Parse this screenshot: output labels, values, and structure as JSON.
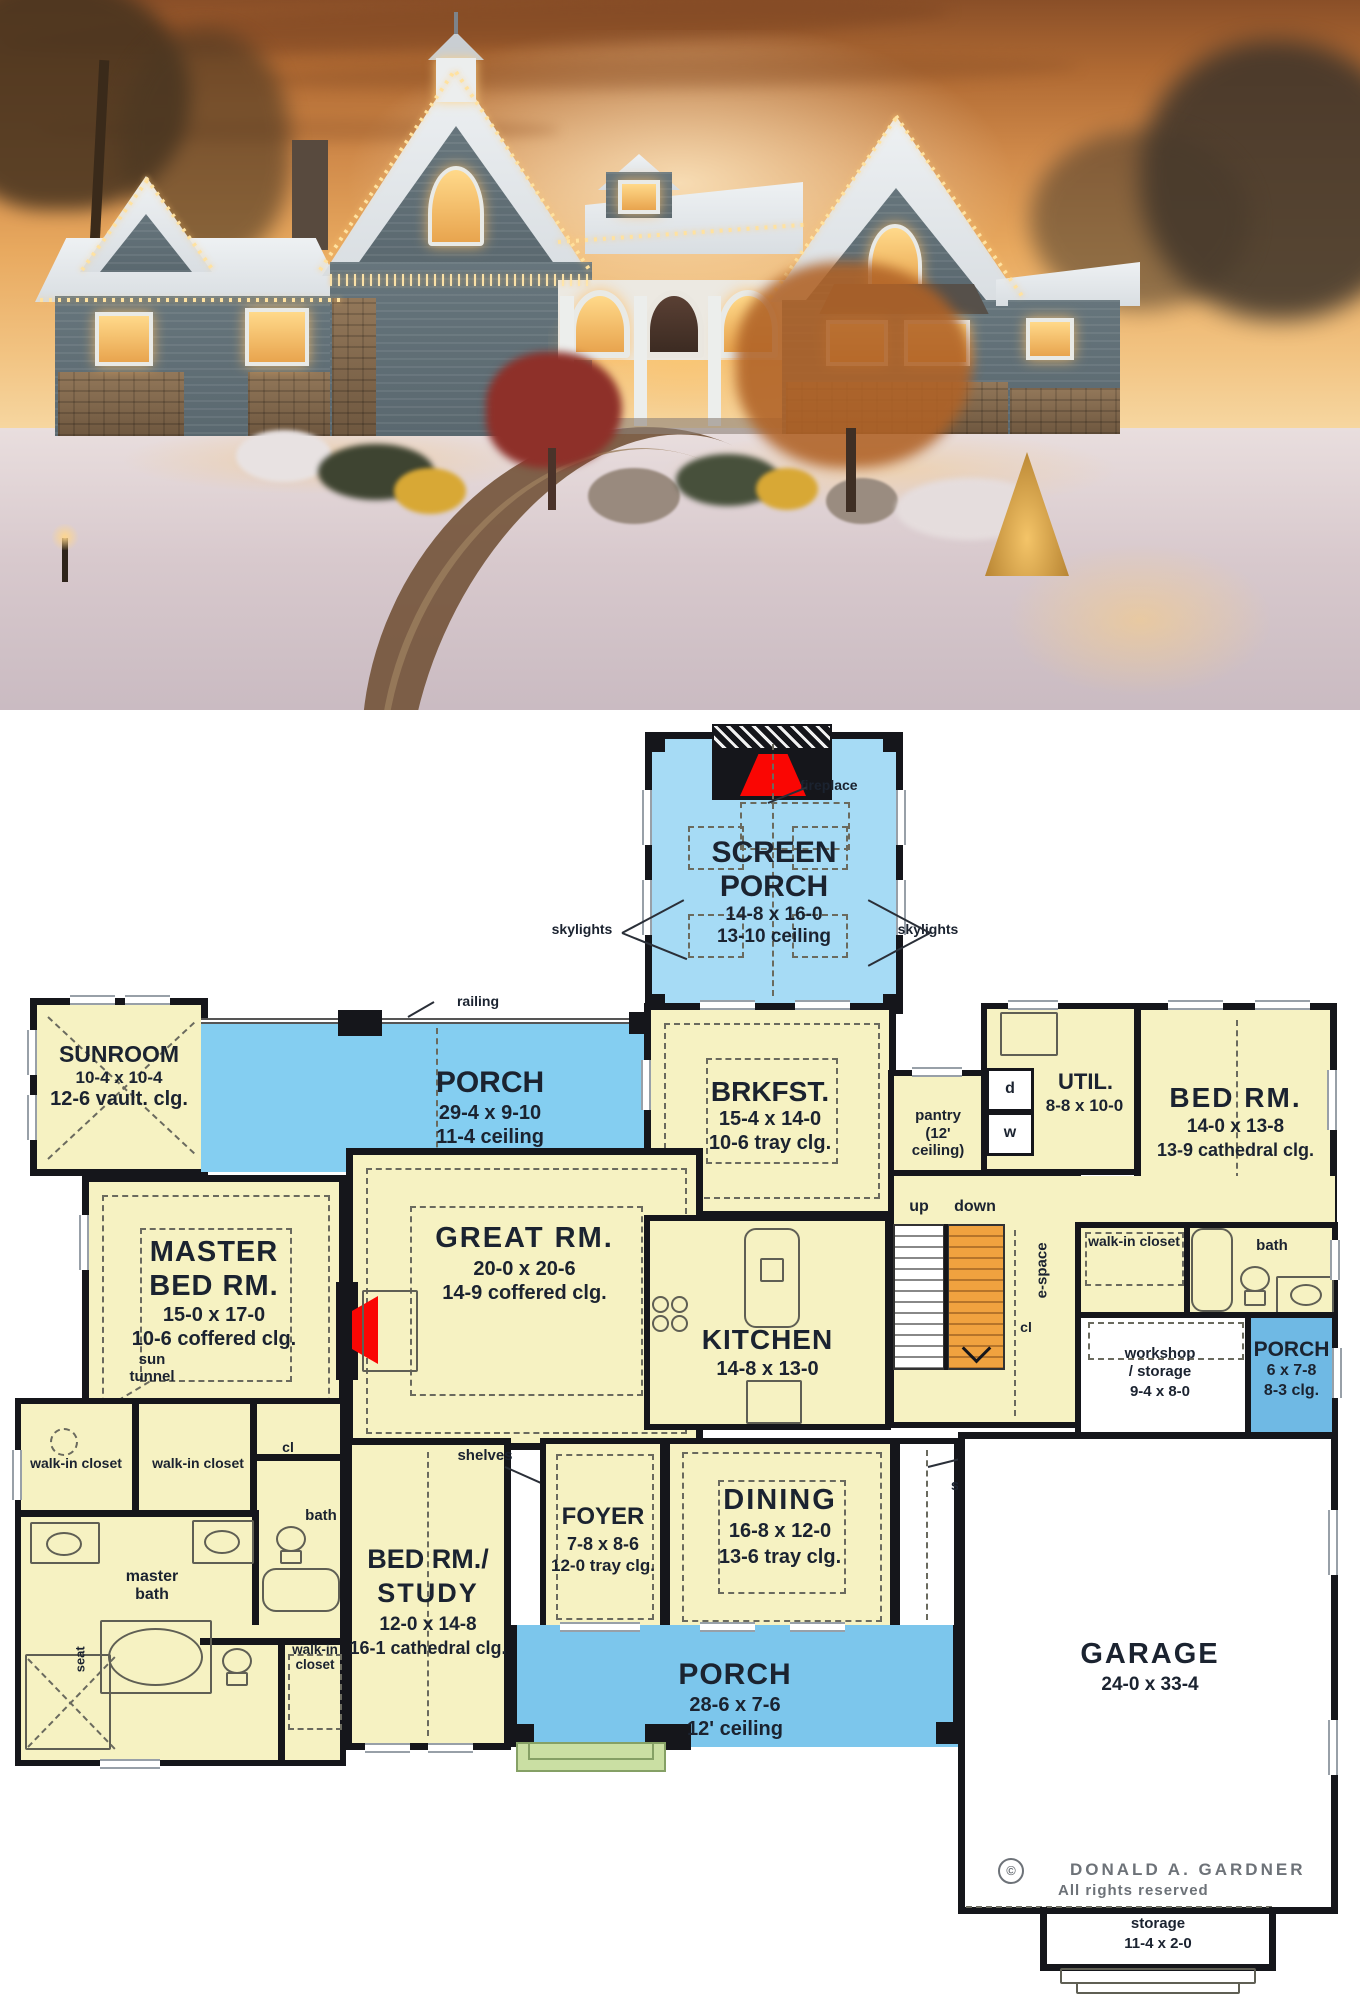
{
  "photo": {
    "description": "craftsman house exterior at dusk with snow and holiday lights"
  },
  "plan": {
    "rooms": {
      "screen_porch": {
        "line1": "SCREEN",
        "line2": "PORCH",
        "dims": "14-8 x 16-0",
        "ceil": "13-10 ceiling"
      },
      "sunroom": {
        "name": "SUNROOM",
        "dims": "10-4 x 10-4",
        "ceil": "12-6 vault. clg."
      },
      "porch_top": {
        "name": "PORCH",
        "dims": "29-4 x 9-10",
        "ceil": "11-4 ceiling"
      },
      "brkfst": {
        "name": "BRKFST.",
        "dims": "15-4 x 14-0",
        "ceil": "10-6 tray clg."
      },
      "pantry": {
        "name": "pantry",
        "ceil": "(12' ceiling)"
      },
      "util": {
        "name": "UTIL.",
        "dims": "8-8 x 10-0"
      },
      "bed_right": {
        "name": "BED RM.",
        "dims": "14-0 x 13-8",
        "ceil": "13-9 cathedral clg."
      },
      "master": {
        "line1": "MASTER",
        "line2": "BED RM.",
        "dims": "15-0 x 17-0",
        "ceil": "10-6 coffered clg."
      },
      "great": {
        "name": "GREAT RM.",
        "dims": "20-0 x 20-6",
        "ceil": "14-9 coffered clg."
      },
      "kitchen": {
        "name": "KITCHEN",
        "dims": "14-8 x 13-0"
      },
      "dining": {
        "name": "DINING",
        "dims": "16-8 x 12-0",
        "ceil": "13-6 tray clg."
      },
      "foyer": {
        "name": "FOYER",
        "dims": "7-8 x 8-6",
        "ceil": "12-0 tray clg."
      },
      "bed_study": {
        "line1": "BED RM./",
        "line2": "STUDY",
        "dims": "12-0 x 14-8",
        "ceil": "16-1 cathedral clg."
      },
      "porch_bottom": {
        "name": "PORCH",
        "dims": "28-6 x 7-6",
        "ceil": "12' ceiling"
      },
      "porch_right": {
        "name": "PORCH",
        "dims": "6 x 7-8",
        "ceil": "8-3 clg."
      },
      "garage": {
        "name": "GARAGE",
        "dims": "24-0 x 33-4"
      },
      "workshop": {
        "line1": "workshop",
        "line2": "/ storage",
        "dims": "9-4 x 8-0"
      },
      "storage_right": {
        "name": "storage",
        "dims1": "3-4 x",
        "dims2": "12-2"
      },
      "storage_bottom": {
        "name": "storage",
        "dims": "11-4 x 2-0"
      }
    },
    "labels": {
      "fireplace": "fireplace",
      "skylights": "skylights",
      "railing": "railing",
      "up": "up",
      "down": "down",
      "espace": "e-space",
      "cl": "cl",
      "d": "d",
      "w": "w",
      "walk_in_closet": "walk-in closet",
      "bath": "bath",
      "master_bath": "master bath",
      "seat": "seat",
      "shelves": "shelves",
      "sun_tunnel": "sun tunnel"
    },
    "copyright": {
      "symbol": "©",
      "name": "DONALD A. GARDNER",
      "rights": "All rights reserved"
    },
    "colors": {
      "room_fill": "#f6f2c2",
      "porch_fill": "#84cef1",
      "screen_porch_fill": "#a6dbf5",
      "small_porch_fill": "#6fb9e4",
      "bottom_porch_fill": "#7cc6ec",
      "stairs": "#f0a23f",
      "fireplace": "#fa0603",
      "step": "#cadfa3",
      "wall": "#15161b"
    }
  }
}
